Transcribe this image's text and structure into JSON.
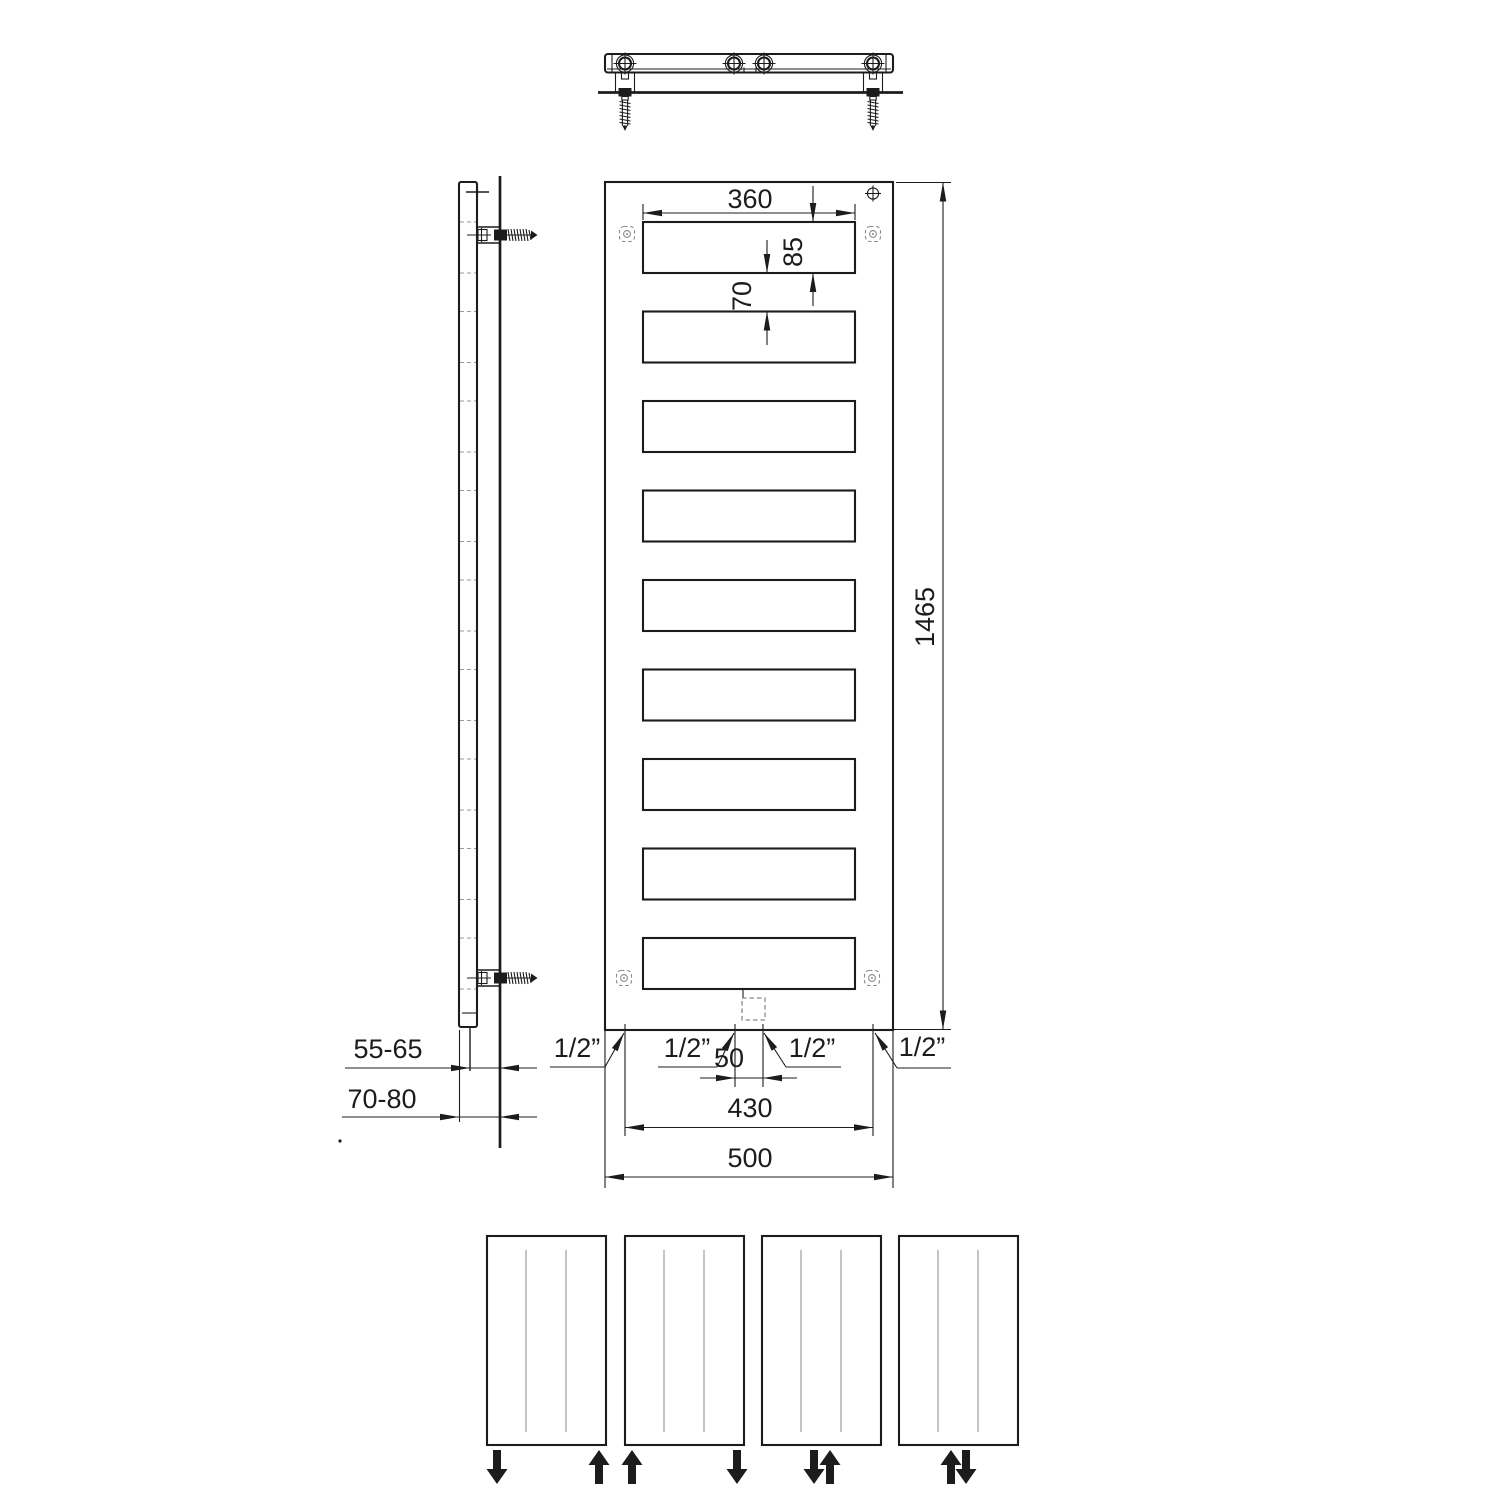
{
  "colors": {
    "line": "#1c1c1c",
    "dashed_detail": "#8a8a8a",
    "panel_hairline": "#b0b0b0",
    "background": "#ffffff"
  },
  "front_view": {
    "dimensions": {
      "slot_width": "360",
      "slot_height": "85",
      "slot_gap": "70",
      "overall_height": "1465",
      "center_connections_spacing": "50",
      "outer_connections_spacing": "430",
      "overall_width": "500"
    },
    "connection_labels": {
      "far_left": "1/2”",
      "center_left": "1/2”",
      "center_right": "1/2”",
      "far_right": "1/2”"
    }
  },
  "side_view": {
    "dimensions": {
      "pipe_axis_to_wall": "55-65",
      "panel_face_to_wall": "70-80"
    }
  },
  "flow_options": [
    {
      "arrows": [
        {
          "position": "outer-left",
          "direction": "down"
        },
        {
          "position": "outer-right",
          "direction": "up"
        }
      ]
    },
    {
      "arrows": [
        {
          "position": "outer-left",
          "direction": "up"
        },
        {
          "position": "outer-right",
          "direction": "down"
        }
      ]
    },
    {
      "arrows": [
        {
          "position": "center-left",
          "direction": "down"
        },
        {
          "position": "center-right",
          "direction": "up"
        }
      ]
    },
    {
      "arrows": [
        {
          "position": "center-left",
          "direction": "up"
        },
        {
          "position": "center-right",
          "direction": "down"
        }
      ]
    }
  ]
}
